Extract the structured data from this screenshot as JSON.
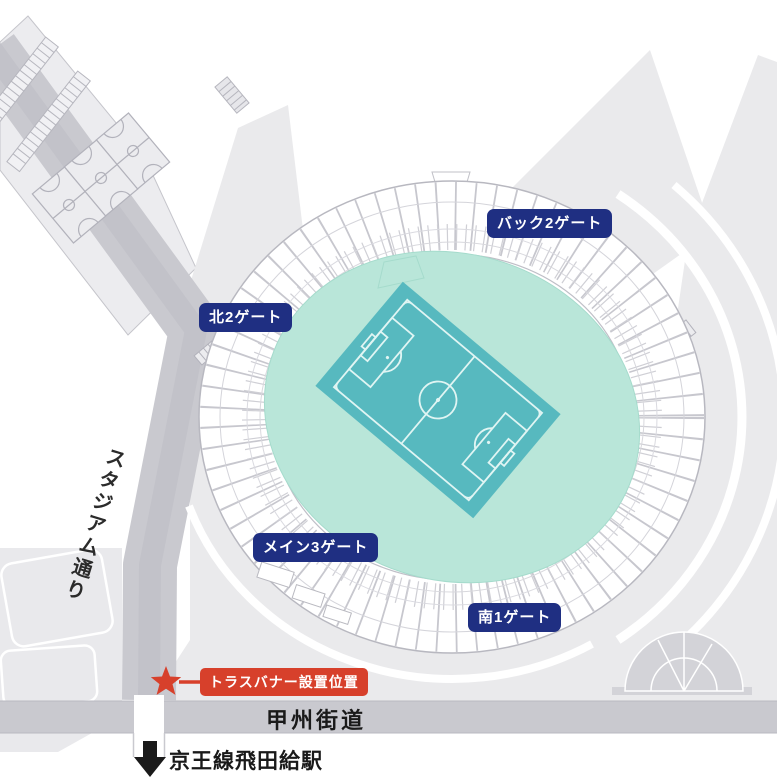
{
  "map": {
    "gates": [
      {
        "id": "back-2-gate",
        "label": "バック2ゲート"
      },
      {
        "id": "north-2-gate",
        "label": "北2ゲート"
      },
      {
        "id": "main-3-gate",
        "label": "メイン3ゲート"
      },
      {
        "id": "south-1-gate",
        "label": "南1ゲート"
      }
    ],
    "roads": {
      "stadium_street": "スタジアム通り",
      "koshu_kaido": "甲州街道"
    },
    "station": {
      "arrow": "↓",
      "label": "京王線飛田給駅"
    },
    "truss_banner": {
      "label": "トラスバナー設置位置"
    },
    "icons": {
      "star": "★",
      "down_arrow": "↓"
    },
    "colors": {
      "gate_badge_blue": "#1f2f82",
      "banner_red": "#d7402b",
      "pitch_teal": "#57b9bf",
      "infield_mint": "#b9e6d9",
      "road_gray": "#c9c9cf",
      "plaza_gray": "#eaeaec",
      "dome_gray": "#d3d3d8",
      "text_black": "#1a1a1a"
    }
  }
}
